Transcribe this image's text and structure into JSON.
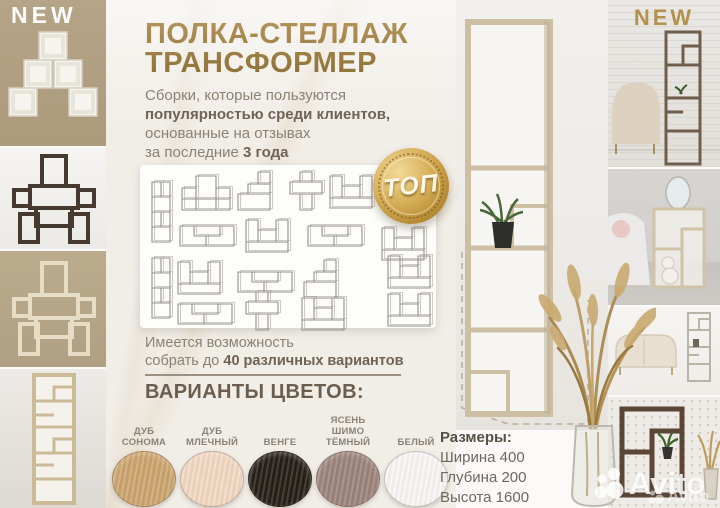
{
  "badges": {
    "new_left": "NEW",
    "new_right": "NEW",
    "top_medal": "ТОП"
  },
  "header": {
    "title_line1": "ПОЛКА-СТЕЛЛАЖ",
    "title_line2": "ТРАНСФОРМЕР"
  },
  "intro": {
    "line1": "Сборки, которые пользуются",
    "line2_bold": "популярностью среди клиентов,",
    "line3": "основанные на отзывах",
    "line4_regular": "за последние ",
    "line4_bold": "3 года"
  },
  "variants_note": {
    "line1": "Имеется возможность",
    "line2_regular": "собрать до ",
    "line2_bold": "40 различных вариантов"
  },
  "colors_section": {
    "heading": "ВАРИАНТЫ ЦВЕТОВ:",
    "swatches": [
      {
        "label": "ДУБ СОНОМА",
        "hex": "#cda56f"
      },
      {
        "label": "ДУБ МЛЕЧНЫЙ",
        "hex": "#f3d8c3"
      },
      {
        "label": "ВЕНГЕ",
        "hex": "#272019"
      },
      {
        "label": "ЯСЕНЬ ШИМО ТЁМНЫЙ",
        "hex": "#9c847c"
      },
      {
        "label": "БЕЛЫЙ",
        "hex": "#f8f7f5"
      }
    ]
  },
  "dimensions": {
    "heading": "Размеры:",
    "width": "Ширина 400",
    "depth": "Глубина 200",
    "height": "Высота 1600"
  },
  "watermark": {
    "brand": "Avito"
  },
  "theme": {
    "gold": "#a8894e",
    "text": "#8b8174",
    "text_bold": "#6f6355",
    "panel_bg": "#fdfdfc"
  }
}
